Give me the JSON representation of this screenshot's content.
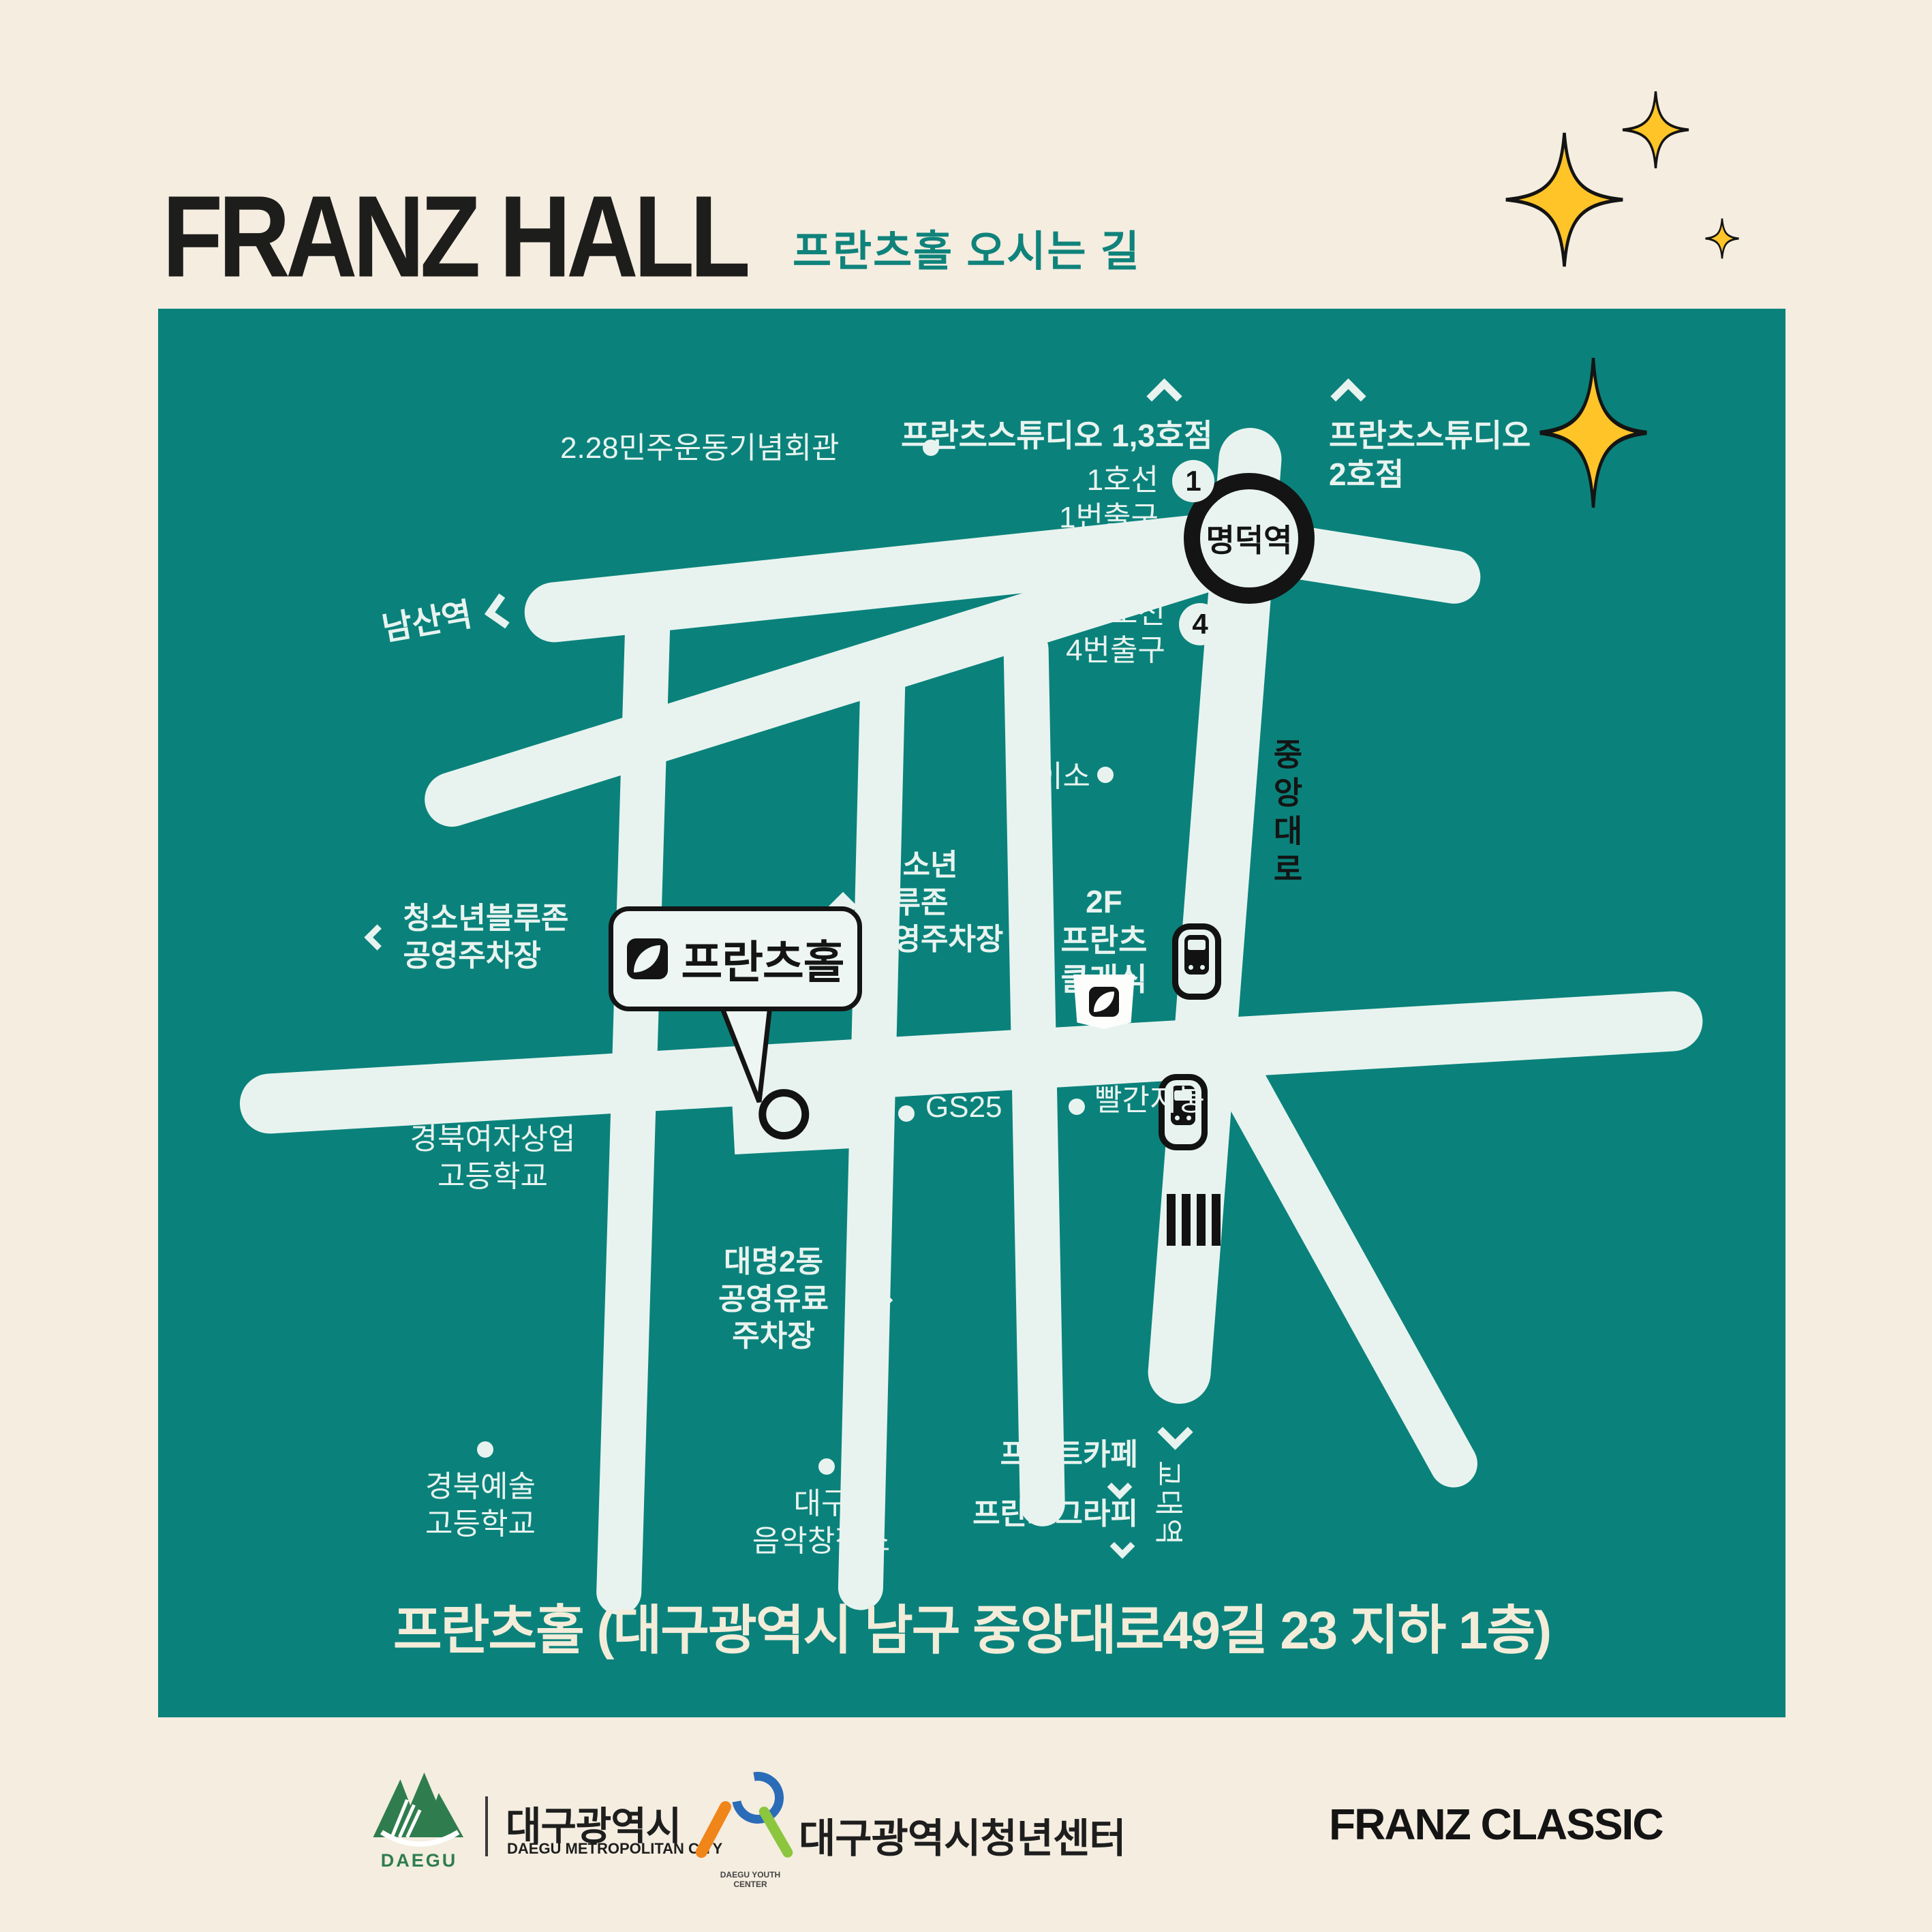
{
  "colors": {
    "page_cream": "#F4EDE0",
    "map_teal": "#0A827B",
    "road_cream": "#E8F3EF",
    "accent_yellow": "#FFC428",
    "ink_black": "#141414",
    "subtitle_teal": "#0F837B",
    "daegu_green": "#2F7D4E",
    "youth_blue": "#2B6CB8",
    "youth_orange": "#F08519",
    "youth_lime": "#8CC63E"
  },
  "header": {
    "title": "FRANZ HALL",
    "subtitle": "프란츠홀 오시는 길"
  },
  "map": {
    "station": {
      "name": "명덕역"
    },
    "exits": {
      "line1": "1호선",
      "exit1": "1번출구",
      "badge1": "1",
      "line3": "3호선",
      "exit4": "4번출구",
      "badge4": "4"
    },
    "roads": {
      "jungang": "중앙대로"
    },
    "directions": {
      "namsan": "남산역",
      "kyodae": "교대역"
    },
    "pois": {
      "memorial": "2.28민주운동기념회관",
      "studio13": "프란츠스튜디오 1,3호점",
      "studio2_1": "프란츠스튜디오",
      "studio2_2": "2호점",
      "daiso": "다이소",
      "bluezone_sm_1": "청소년블루존",
      "bluezone_sm_2": "공영주차장",
      "bluezone_lg_1": "청소년",
      "bluezone_lg_2": "블루존",
      "bluezone_lg_3": "공영주차장",
      "franz_hall": "프란츠홀",
      "franz_classic_1": "2F",
      "franz_classic_2": "프란츠",
      "franz_classic_3": "클래식",
      "gs25": "GS25",
      "red_roof": "빨간지붕",
      "girls_hs_1": "경북여자상업",
      "girls_hs_2": "고등학교",
      "daemyeong_1": "대명2동",
      "daemyeong_2": "공영유료",
      "daemyeong_3": "주차장",
      "art_hs_1": "경북예술",
      "art_hs_2": "고등학교",
      "music_1": "대구",
      "music_2": "음악창작소",
      "print_cafe": "프린트카페",
      "franzgraphy": "프란츠그라피"
    },
    "address": "프란츠홀 (대구광역시 남구 중앙대로49길 23 지하 1층)"
  },
  "footer": {
    "daegu_logo": "DAEGU",
    "daegu_kr": "대구광역시",
    "daegu_en": "DAEGU METROPOLITAN CITY",
    "youth_kr": "대구광역시청년센터",
    "youth_en": "DAEGU YOUTH CENTER",
    "franz_classic": "FRANZ CLASSIC"
  }
}
